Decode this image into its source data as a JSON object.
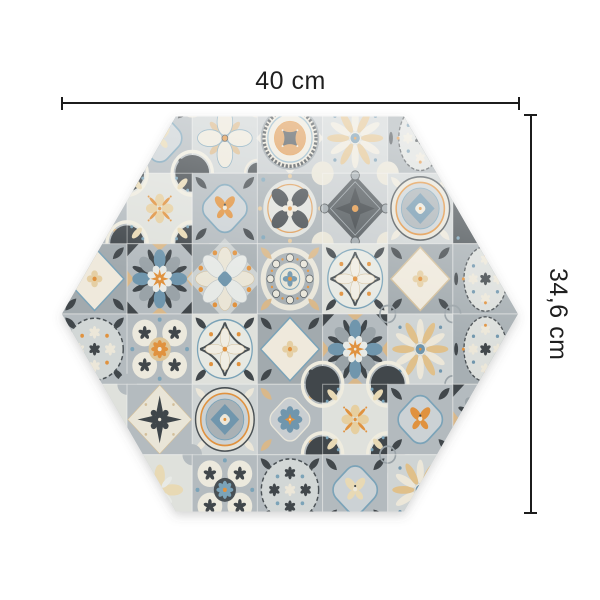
{
  "diagram": {
    "shape": "hexagon",
    "width_label": "40 cm",
    "height_label": "34,6 cm"
  },
  "tile_design": {
    "palette": {
      "ground": "#b4bbbf",
      "groundMid": "#cfd4d4",
      "groundLight": "#dfe1dc",
      "cream": "#ece7d9",
      "white": "#e8eae6",
      "charcoal": "#41474b",
      "charcoalDeep": "#31373b",
      "slate": "#4a5155",
      "blue": "#7096ad",
      "blueLight": "#7ba3b8",
      "orange": "#e0923f",
      "orangeSoft": "#dd9a55",
      "tan": "#d9b88a",
      "tanPale": "#e8d9b4",
      "gray": "#9aa3a8",
      "line": "#1c1c1c"
    },
    "grid": {
      "cols": 7,
      "rows": 6,
      "cells": [
        [
          "pale-flower",
          "quatrefoil-moth.1",
          "flower4-ring-corners",
          "medallion-rings",
          "flower12",
          "oval-medallion",
          "pale-flower"
        ],
        [
          "quatrefoil-flower-blue",
          "cross-orange-sprigs",
          "quatrefoil-moth",
          "blades-circle",
          "dark-diamond-star",
          "ring-diamond",
          "dark-ornament"
        ],
        [
          "diamond-white",
          "star8",
          "flower8-blue",
          "circle-ring",
          "compass-circle",
          "diamond-white.1",
          "oval-medallion"
        ],
        [
          "snowflake-circle",
          "quatrefoil-circles",
          "compass-circle",
          "diamond-white",
          "star8",
          "flower12",
          "oval-medallion"
        ],
        [
          "pale-flower",
          "cross-dark",
          "ring-diamond",
          "quatrefoil-flower-blue",
          "cross-orange-sprigs",
          "quatrefoil-moth",
          "star8"
        ],
        [
          "flower12",
          "pale-flower",
          "quatrefoil-circles.1",
          "snowflake-circle.1",
          "quatrefoil-moth.1",
          "flower12",
          "pale-flower"
        ]
      ]
    }
  }
}
